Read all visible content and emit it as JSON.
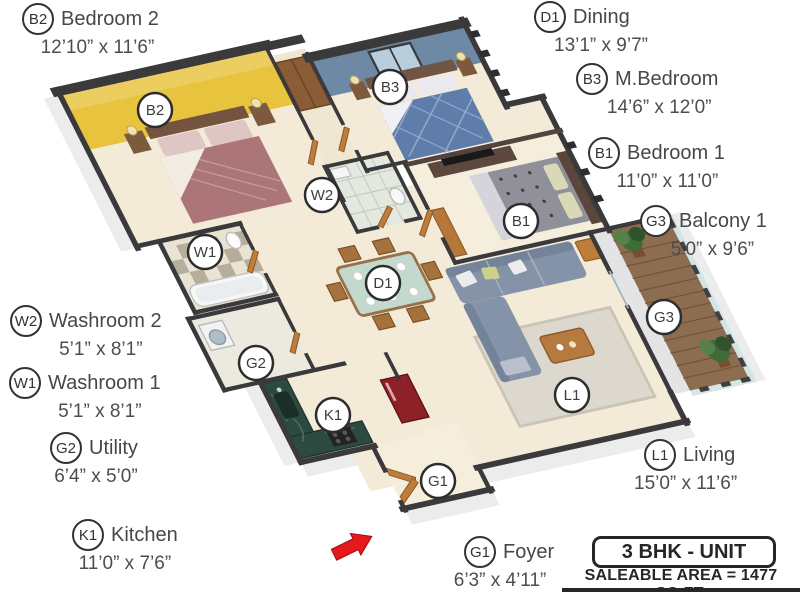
{
  "rooms": [
    {
      "code": "B2",
      "name": "Bedroom 2",
      "dims": "12’10” x 11’6”"
    },
    {
      "code": "D1",
      "name": "Dining",
      "dims": "13’1” x 9’7”"
    },
    {
      "code": "B3",
      "name": "M.Bedroom",
      "dims": "14’6” x 12’0”"
    },
    {
      "code": "B1",
      "name": "Bedroom 1",
      "dims": "11’0” x 11’0”"
    },
    {
      "code": "G3",
      "name": "Balcony 1",
      "dims": "5’0” x 9’6”"
    },
    {
      "code": "W2",
      "name": "Washroom 2",
      "dims": "5’1” x 8’1”"
    },
    {
      "code": "W1",
      "name": "Washroom 1",
      "dims": "5’1” x 8’1”"
    },
    {
      "code": "G2",
      "name": "Utility",
      "dims": "6’4” x 5’0”"
    },
    {
      "code": "K1",
      "name": "Kitchen",
      "dims": "11’0” x 7’6”"
    },
    {
      "code": "G1",
      "name": "Foyer",
      "dims": "6’3” x 4’11”"
    },
    {
      "code": "L1",
      "name": "Living",
      "dims": "15’0” x 11’6”"
    }
  ],
  "unit": {
    "type_label": "3 BHK - UNIT",
    "saleable_area": "SALEABLE AREA = 1477 SQ.FT."
  },
  "colors": {
    "accent_wall_yellow": "#e8c33e",
    "accent_wall_blue": "#6e89a6",
    "wall_dark": "#3a393b",
    "floor_cream": "#f3ebd7",
    "door_wood": "#bf7d3c",
    "kitchen_counter_green": "#2c4a40",
    "refrigerator_red": "#8c2127",
    "sofa_gray_blue": "#8593a8",
    "balcony_deck_brown": "#8d6d50",
    "plant_green": "#3e6b38",
    "entrance_arrow_red": "#e8191c"
  }
}
